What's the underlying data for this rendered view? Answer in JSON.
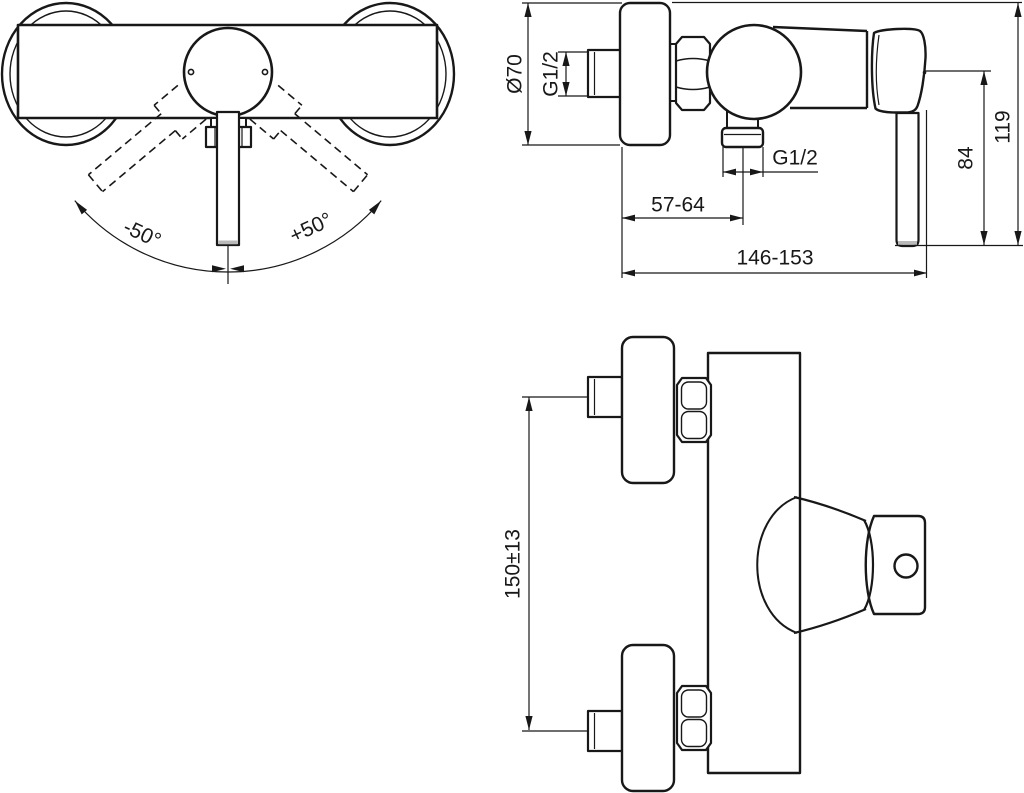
{
  "drawing": {
    "subject": "wall-mounted single-lever shower mixer, dimensional drawing"
  },
  "colors": {
    "line": "#181818",
    "background": "#ffffff",
    "shading": "#b9b9b9"
  },
  "front_view": {
    "angle_left": "-50°",
    "angle_right": "+50°"
  },
  "side_view": {
    "escutcheon_diameter": "Ø70",
    "inlet_thread": "G1/2",
    "outlet_thread": "G1/2",
    "wall_to_outlet_center": "57-64",
    "overall_depth": "146-153",
    "outlet_to_handle_end": "84",
    "height_total": "119"
  },
  "plan_view": {
    "inlet_spacing": "150±13"
  }
}
